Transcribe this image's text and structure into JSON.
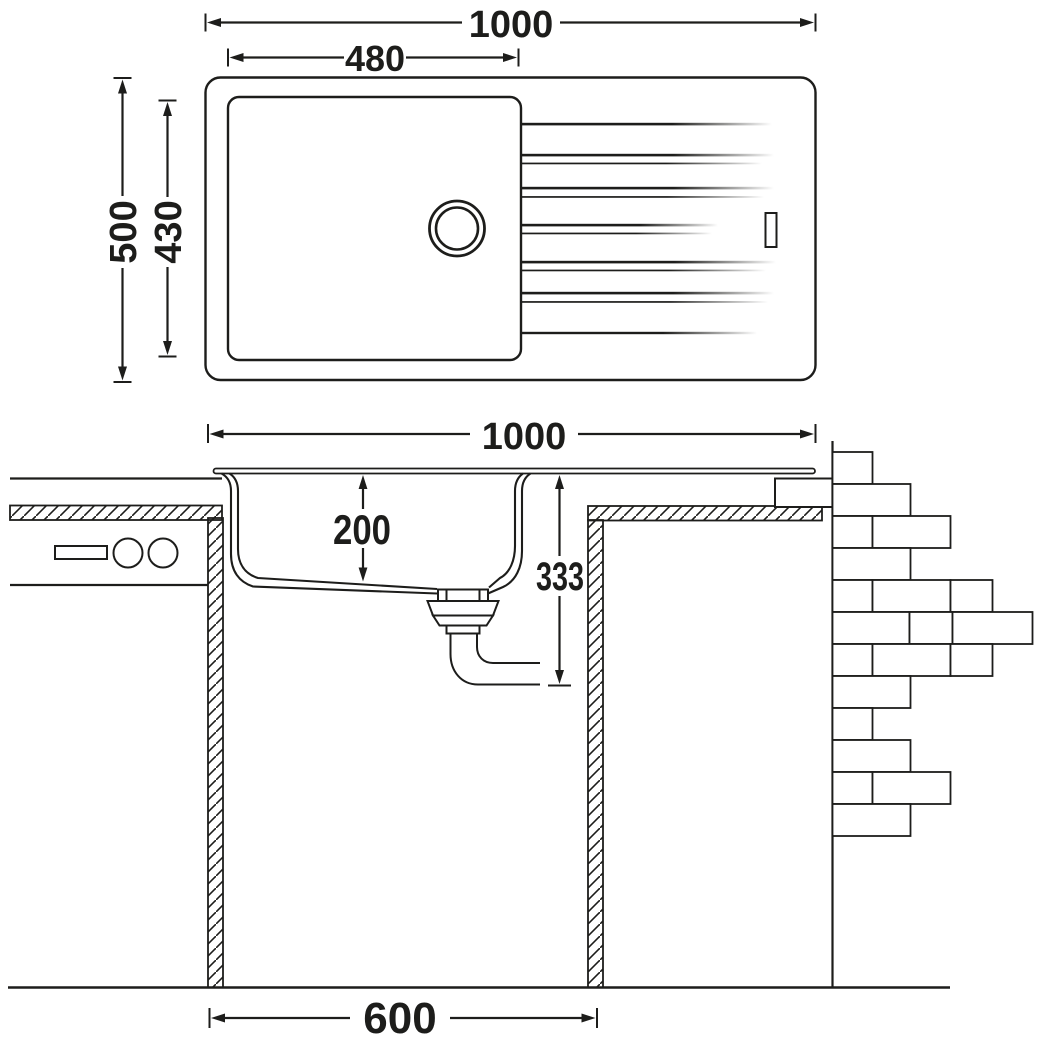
{
  "drawing": {
    "type": "kitchen-sink-installation-drawing",
    "colors": {
      "line": "#1d1d1b",
      "background": "#ffffff"
    },
    "top_view": {
      "overall_width_mm": "1000",
      "bowl_width_mm": "480",
      "overall_depth_mm": "500",
      "bowl_depth_mm": "430"
    },
    "section_view": {
      "overall_width_mm": "1000",
      "bowl_depth_mm": "200",
      "installation_depth_mm": "333",
      "cabinet_width_mm": "600"
    }
  }
}
